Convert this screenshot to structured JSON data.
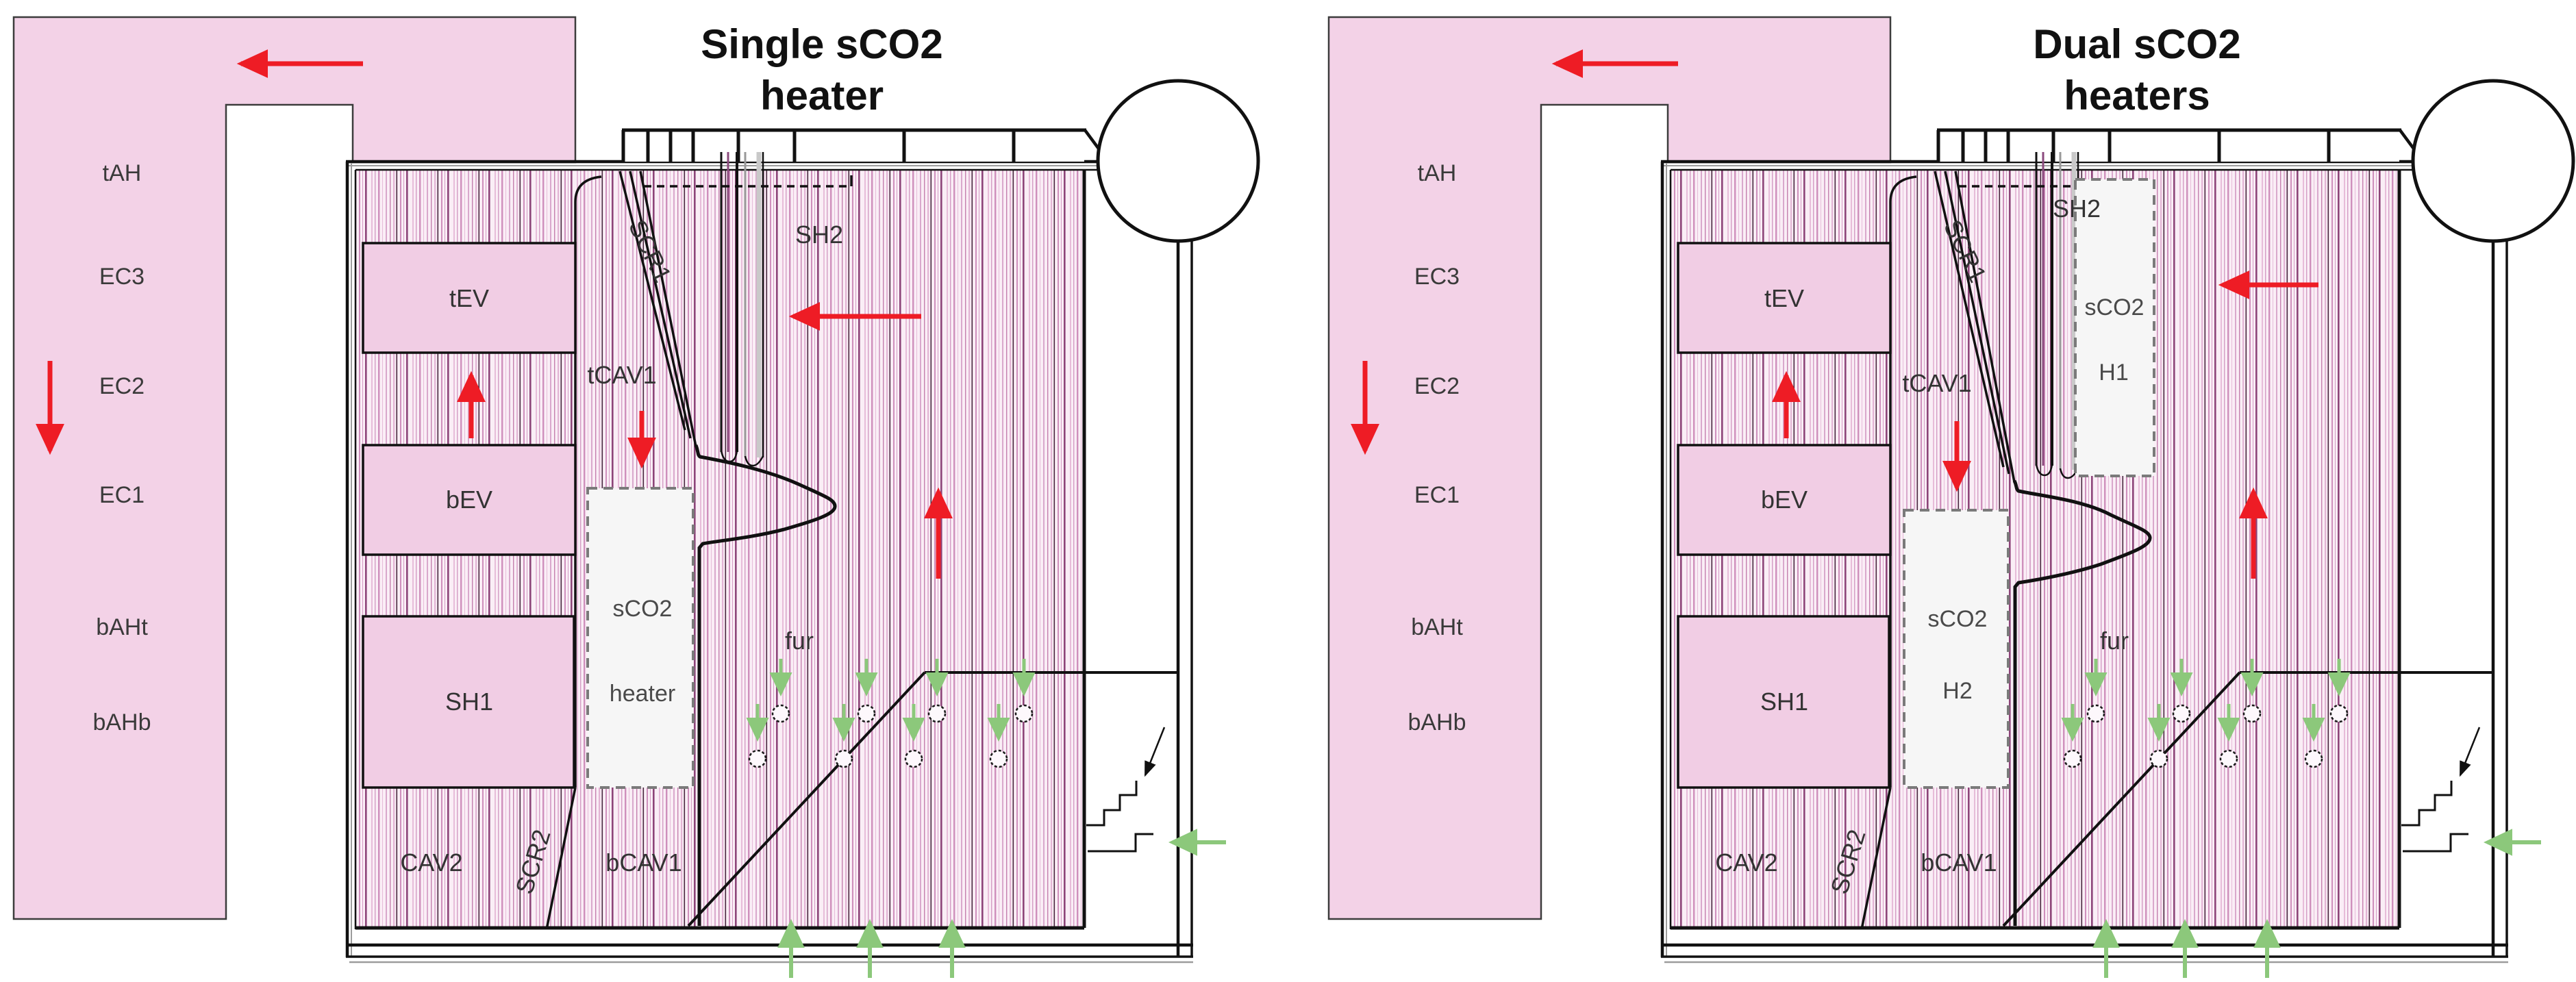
{
  "figure": {
    "type": "boiler-configuration-comparison",
    "background": "#ffffff"
  },
  "colors": {
    "duct_pink": "#f3d2e7",
    "box_pink": "#f1cde4",
    "stripe_pink": "#cf8fbc",
    "stripe_dark": "#7c3a68",
    "heater_box_fill": "#f6f6f6",
    "heater_box_border": "#7a7a7a",
    "flow_red": "#ee1c25",
    "air_green": "#8cc87b",
    "line_black": "#111111"
  },
  "diagrams": [
    {
      "title": [
        "Single sCO2",
        "heater"
      ],
      "duct_labels": [
        "tAH",
        "EC3",
        "EC2",
        "EC1",
        "bAHt",
        "bAHb"
      ],
      "labels": {
        "tev": "tEV",
        "bev": "bEV",
        "sh1": "SH1",
        "cav2": "CAV2",
        "scr2": "SCR2",
        "bcav1": "bCAV1",
        "tcav1": "tCAV1",
        "scr1": "SCR1",
        "sh2": "SH2",
        "fur": "fur"
      },
      "heaters": [
        {
          "l1": "sCO2",
          "l2": "heater"
        }
      ]
    },
    {
      "title": [
        "Dual sCO2",
        "heaters"
      ],
      "duct_labels": [
        "tAH",
        "EC3",
        "EC2",
        "EC1",
        "bAHt",
        "bAHb"
      ],
      "labels": {
        "tev": "tEV",
        "bev": "bEV",
        "sh1": "SH1",
        "cav2": "CAV2",
        "scr2": "SCR2",
        "bcav1": "bCAV1",
        "tcav1": "tCAV1",
        "scr1": "SCR1",
        "sh2": "SH2",
        "fur": "fur"
      },
      "heaters": [
        {
          "l1": "sCO2",
          "l2": "H1"
        },
        {
          "l1": "sCO2",
          "l2": "H2"
        }
      ]
    }
  ]
}
